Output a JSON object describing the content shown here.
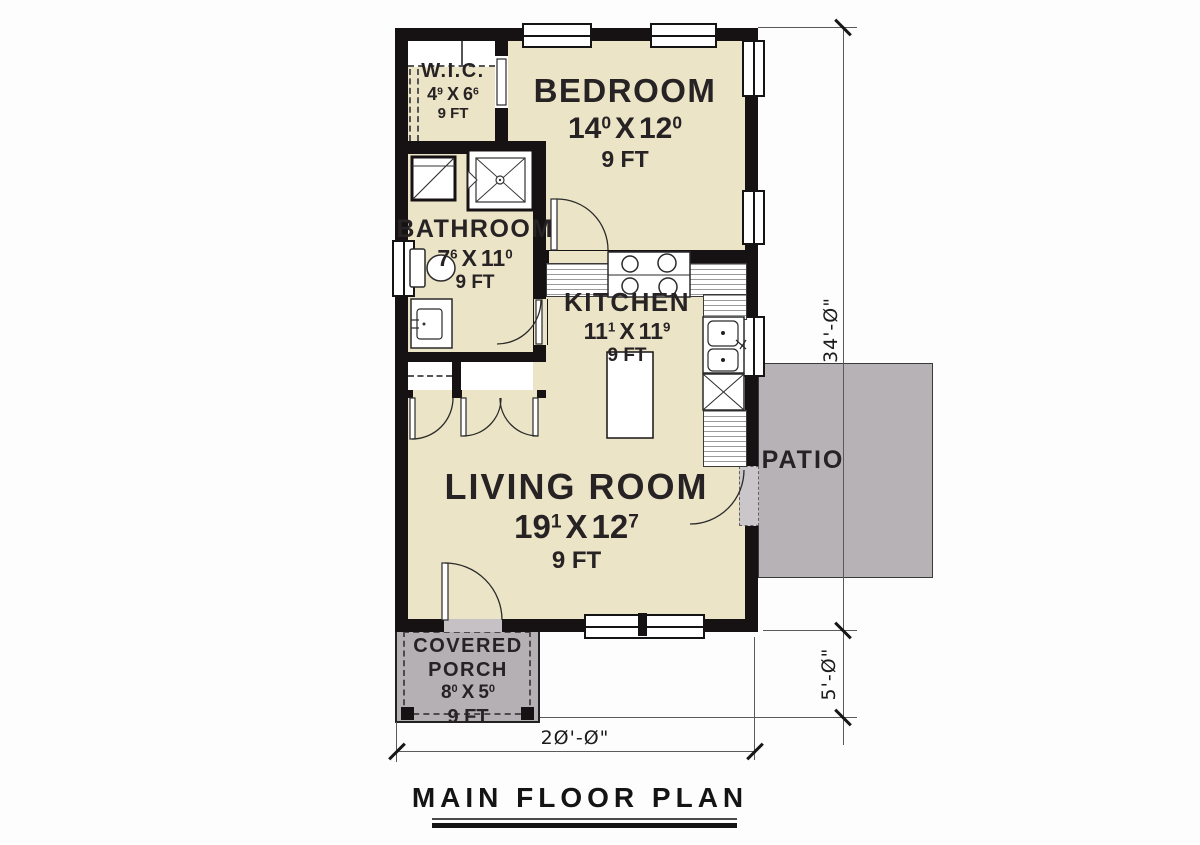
{
  "title": "MAIN FLOOR PLAN",
  "rooms": {
    "wic": {
      "name": "W.I.C.",
      "w": "4",
      "w_sup": "9",
      "x": "X",
      "l": "6",
      "l_sup": "6",
      "ceiling": "9 FT"
    },
    "bedroom": {
      "name": "BEDROOM",
      "w": "14",
      "w_sup": "0",
      "x": "X",
      "l": "12",
      "l_sup": "0",
      "ceiling": "9 FT"
    },
    "bathroom": {
      "name": "BATHROOM",
      "w": "7",
      "w_sup": "6",
      "x": "X",
      "l": "11",
      "l_sup": "0",
      "ceiling": "9 FT"
    },
    "kitchen": {
      "name": "KITCHEN",
      "w": "11",
      "w_sup": "1",
      "x": "X",
      "l": "11",
      "l_sup": "9",
      "ceiling": "9 FT"
    },
    "living": {
      "name": "LIVING ROOM",
      "w": "19",
      "w_sup": "1",
      "x": "X",
      "l": "12",
      "l_sup": "7",
      "ceiling": "9 FT"
    },
    "porch": {
      "line1": "COVERED",
      "line2": "PORCH",
      "w": "8",
      "w_sup": "0",
      "x": "X",
      "l": "5",
      "l_sup": "0",
      "ceiling": "9 FT"
    },
    "patio": {
      "name": "PATIO"
    }
  },
  "dimensions": {
    "overall_depth": "34'-Ø\"",
    "porch_depth": "5'-Ø\"",
    "overall_width": "2Ø'-Ø\""
  },
  "colors": {
    "floor": "#ebe4c6",
    "wall": "#161213",
    "patio": "#b6b2b6",
    "porch": "#b4b0b4",
    "label_text": "#272224"
  }
}
